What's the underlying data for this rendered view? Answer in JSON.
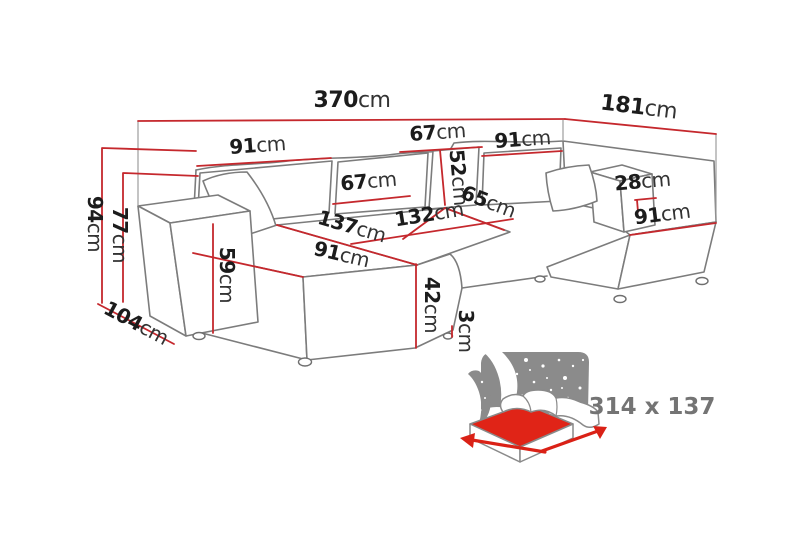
{
  "meta": {
    "description": "U-shaped sectional sofa dimension diagram",
    "colors": {
      "dimension_red": "#c5282d",
      "icon_red": "#e02417",
      "sofa_outline_gray": "#7c7c7c",
      "icon_backdrop_gray": "#8b8b8b",
      "label_black": "#1c1c1c",
      "icon_label_gray": "#747474",
      "background": "#ffffff"
    }
  },
  "dims": {
    "total_width": {
      "value": "370",
      "unit": "cm"
    },
    "side_depth": {
      "value": "181",
      "unit": "cm"
    },
    "back_cushion_left": {
      "value": "91",
      "unit": "cm"
    },
    "back_cushion_top": {
      "value": "67",
      "unit": "cm"
    },
    "back_cushion_height": {
      "value": "52",
      "unit": "cm"
    },
    "back_cushion_right": {
      "value": "91",
      "unit": "cm"
    },
    "back_cushion_mid": {
      "value": "67",
      "unit": "cm"
    },
    "armrest_right_width": {
      "value": "28",
      "unit": "cm"
    },
    "seat_depth_right": {
      "value": "65",
      "unit": "cm"
    },
    "seat_mid_width": {
      "value": "132",
      "unit": "cm"
    },
    "chaise_right_width": {
      "value": "91",
      "unit": "cm"
    },
    "chaise_left_length": {
      "value": "137",
      "unit": "cm"
    },
    "chaise_left_width": {
      "value": "91",
      "unit": "cm"
    },
    "total_height": {
      "value": "94",
      "unit": "cm"
    },
    "back_height": {
      "value": "77",
      "unit": "cm"
    },
    "armrest_height": {
      "value": "59",
      "unit": "cm"
    },
    "armrest_left_depth": {
      "value": "104",
      "unit": "cm"
    },
    "seat_height": {
      "value": "42",
      "unit": "cm"
    },
    "leg_height": {
      "value": "3",
      "unit": "cm"
    }
  },
  "sleeping_area": {
    "size_label": "314 x 137"
  }
}
